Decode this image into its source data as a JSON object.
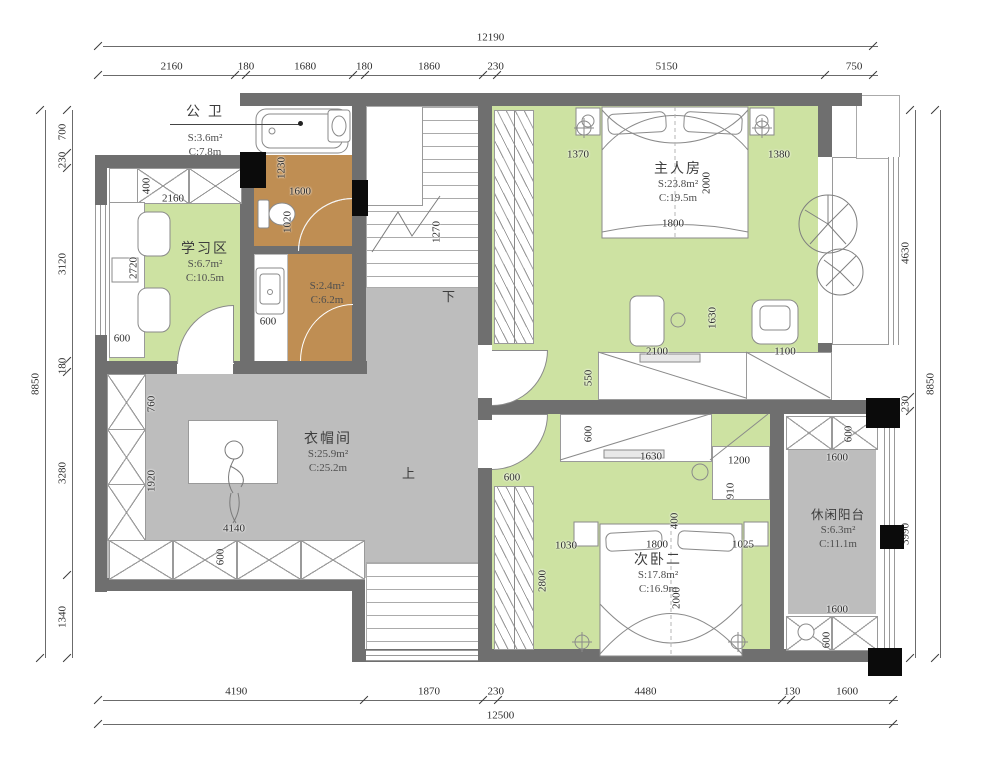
{
  "colors": {
    "wall": "#6f6f6f",
    "green": "#cde2a2",
    "gray": "#bdbdbd",
    "brown": "#bf8e53",
    "column": "#0b0b0b",
    "line": "#9a9a9a"
  },
  "rooms": {
    "gongwei": {
      "name": "公 卫",
      "s": "S:3.6m²",
      "c": "C:7.8m"
    },
    "xuexiqu": {
      "name": "学习区",
      "s": "S:6.7m²",
      "c": "C:10.5m"
    },
    "zhurenfang": {
      "name": "主人房",
      "s": "S:23.8m²",
      "c": "C:19.5m"
    },
    "yimaojian": {
      "name": "衣帽间",
      "s": "S:25.9m²",
      "c": "C:25.2m"
    },
    "ciwoer": {
      "name": "次卧二",
      "s": "S:17.8m²",
      "c": "C:16.9m"
    },
    "yangtai": {
      "name": "休闲阳台",
      "s": "S:6.3m²",
      "c": "C:11.1m"
    },
    "bath2": {
      "s": "S:2.4m²",
      "c": "C:6.2m"
    }
  },
  "stairs": {
    "down": "下",
    "up": "上"
  },
  "dims": {
    "top": {
      "total": "12190",
      "segments": [
        "2160",
        "180",
        "1680",
        "180",
        "1860",
        "230",
        "5150",
        "750"
      ]
    },
    "bottom": {
      "total": "12500",
      "segments": [
        "4190",
        "1870",
        "230",
        "4480",
        "130",
        "1600"
      ]
    },
    "left": {
      "total": "8850",
      "segments": [
        "700",
        "230",
        "3120",
        "180",
        "3280",
        "1340"
      ]
    },
    "right": {
      "total": "8850",
      "segments": [
        "4630",
        "230",
        "3990"
      ]
    }
  },
  "interior_dims": [
    {
      "v": "1230",
      "x": 282,
      "y": 168,
      "r": 90
    },
    {
      "v": "1600",
      "x": 300,
      "y": 192,
      "r": 0
    },
    {
      "v": "1020",
      "x": 288,
      "y": 222,
      "r": 90
    },
    {
      "v": "2160",
      "x": 173,
      "y": 199,
      "r": 0
    },
    {
      "v": "400",
      "x": 147,
      "y": 186,
      "r": 90
    },
    {
      "v": "2720",
      "x": 134,
      "y": 268,
      "r": 90
    },
    {
      "v": "600",
      "x": 122,
      "y": 339,
      "r": 0
    },
    {
      "v": "1270",
      "x": 437,
      "y": 232,
      "r": 90
    },
    {
      "v": "600",
      "x": 268,
      "y": 322,
      "r": 0
    },
    {
      "v": "1370",
      "x": 578,
      "y": 155,
      "r": 0
    },
    {
      "v": "1380",
      "x": 779,
      "y": 155,
      "r": 0
    },
    {
      "v": "2000",
      "x": 707,
      "y": 183,
      "r": 90
    },
    {
      "v": "1800",
      "x": 673,
      "y": 224,
      "r": 0
    },
    {
      "v": "1630",
      "x": 713,
      "y": 318,
      "r": 90
    },
    {
      "v": "2100",
      "x": 657,
      "y": 352,
      "r": 0
    },
    {
      "v": "1100",
      "x": 785,
      "y": 352,
      "r": 0
    },
    {
      "v": "550",
      "x": 589,
      "y": 378,
      "r": 90
    },
    {
      "v": "600",
      "x": 589,
      "y": 434,
      "r": 90
    },
    {
      "v": "1630",
      "x": 651,
      "y": 457,
      "r": 0
    },
    {
      "v": "1200",
      "x": 739,
      "y": 461,
      "r": 0
    },
    {
      "v": "910",
      "x": 731,
      "y": 491,
      "r": 90
    },
    {
      "v": "400",
      "x": 675,
      "y": 521,
      "r": 90
    },
    {
      "v": "600",
      "x": 849,
      "y": 434,
      "r": 90
    },
    {
      "v": "1600",
      "x": 837,
      "y": 458,
      "r": 0
    },
    {
      "v": "600",
      "x": 512,
      "y": 478,
      "r": 0
    },
    {
      "v": "1030",
      "x": 566,
      "y": 546,
      "r": 0
    },
    {
      "v": "1800",
      "x": 657,
      "y": 545,
      "r": 0
    },
    {
      "v": "1025",
      "x": 743,
      "y": 545,
      "r": 0
    },
    {
      "v": "2800",
      "x": 543,
      "y": 581,
      "r": 90
    },
    {
      "v": "2000",
      "x": 677,
      "y": 598,
      "r": 90
    },
    {
      "v": "1600",
      "x": 837,
      "y": 610,
      "r": 0
    },
    {
      "v": "600",
      "x": 827,
      "y": 640,
      "r": 90
    },
    {
      "v": "4140",
      "x": 234,
      "y": 529,
      "r": 0
    },
    {
      "v": "600",
      "x": 221,
      "y": 557,
      "r": 90
    },
    {
      "v": "760",
      "x": 152,
      "y": 404,
      "r": 90
    },
    {
      "v": "1920",
      "x": 152,
      "y": 481,
      "r": 90
    }
  ]
}
